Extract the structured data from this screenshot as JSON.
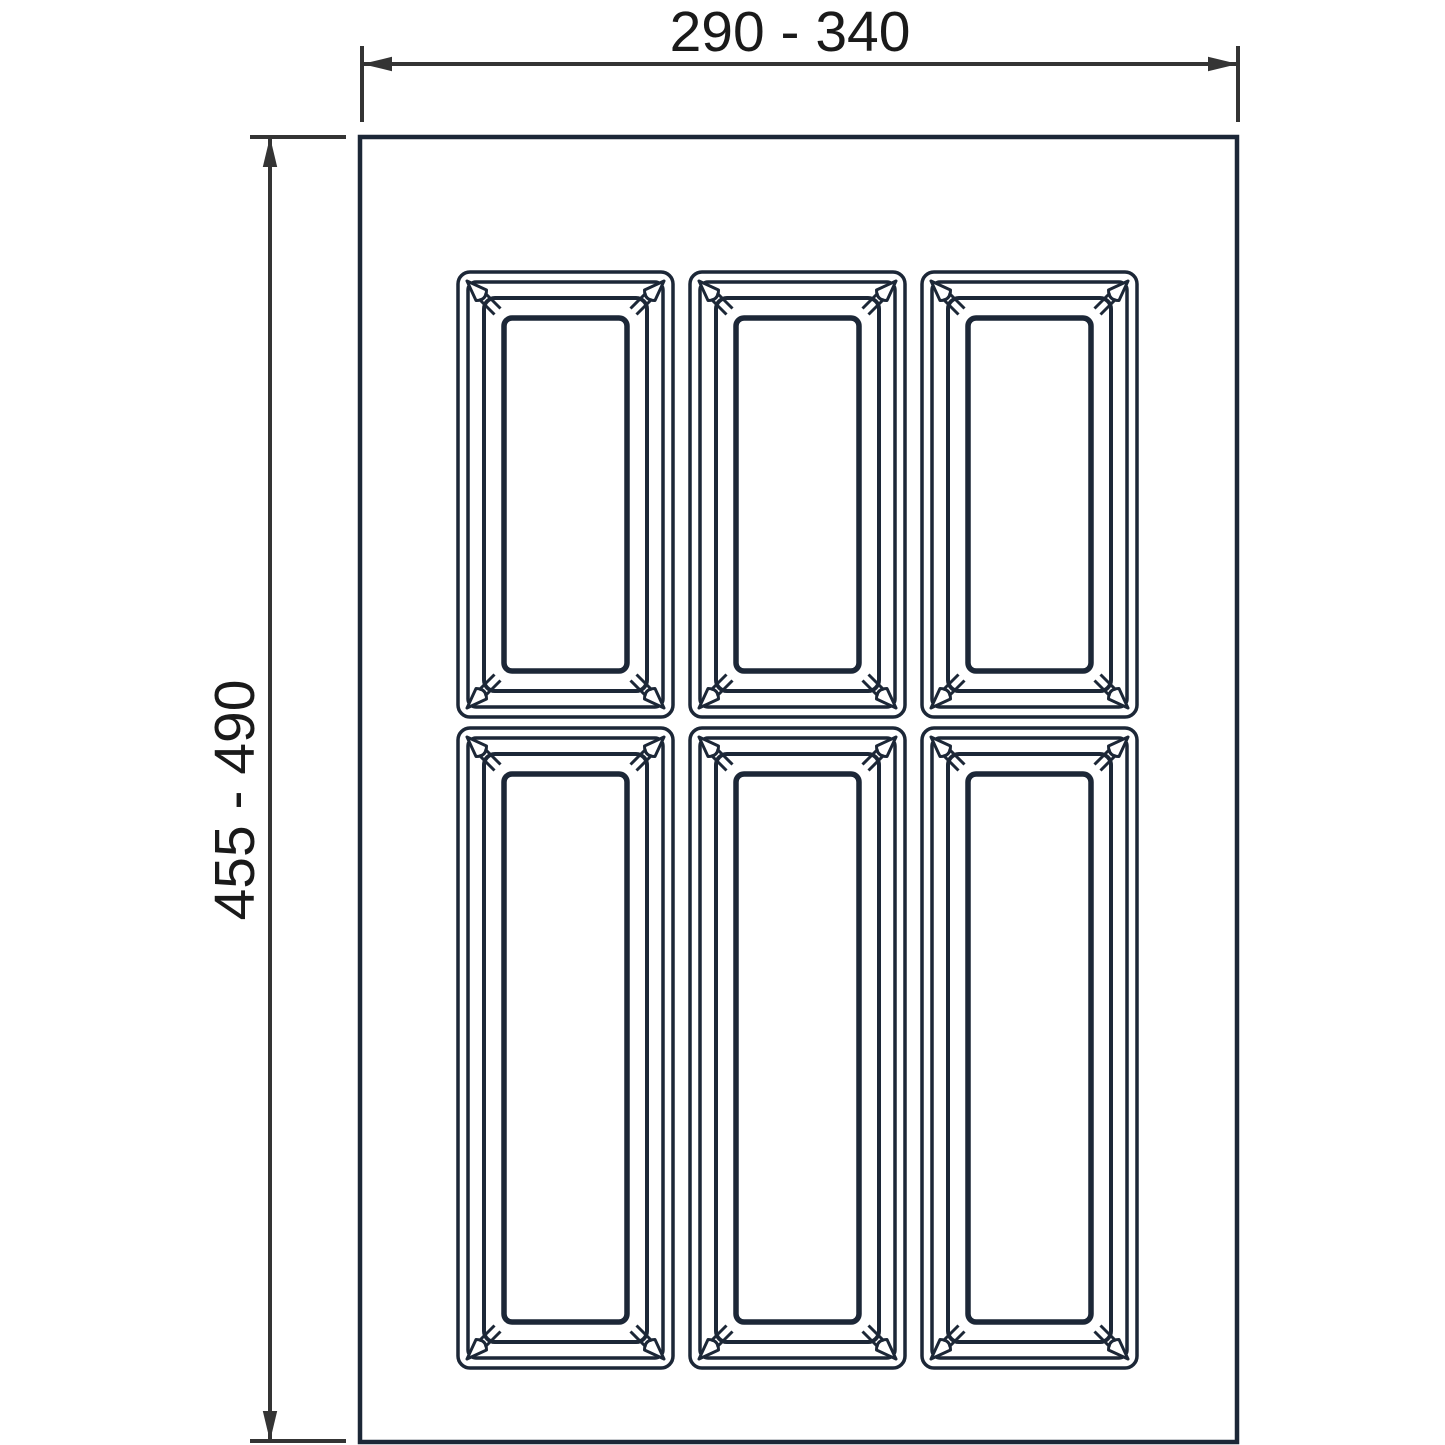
{
  "diagram": {
    "type": "technical-drawing",
    "subject": "cutlery-tray-insert-top-view",
    "width_label": "290 - 340",
    "height_label": "455 - 490",
    "colors": {
      "drawing_line": "#1c2737",
      "dimension_line": "#343434",
      "label_text": "#1a1a1a",
      "background": "#ffffff"
    },
    "tray": {
      "x": 360,
      "y": 137,
      "w": 877,
      "h": 1305
    },
    "layout": {
      "rows": 2,
      "cols": 3,
      "compartment_count": 6
    },
    "compartments": [
      {
        "x": 458,
        "y": 272,
        "w": 215,
        "h": 445
      },
      {
        "x": 690,
        "y": 272,
        "w": 215,
        "h": 445
      },
      {
        "x": 922,
        "y": 272,
        "w": 215,
        "h": 445
      },
      {
        "x": 458,
        "y": 728,
        "w": 215,
        "h": 640
      },
      {
        "x": 690,
        "y": 728,
        "w": 215,
        "h": 640
      },
      {
        "x": 922,
        "y": 728,
        "w": 215,
        "h": 640
      }
    ],
    "width_dimension": {
      "line_y": 64,
      "x1": 362,
      "x2": 1238,
      "tick_y1": 46,
      "tick_y2": 122,
      "label_x": 790,
      "label_baseline_y": 51
    },
    "height_dimension": {
      "line_x": 270,
      "y1": 137,
      "y2": 1441,
      "tick_x1": 250,
      "tick_x2": 346,
      "label_x": 254,
      "label_center_y": 800
    }
  }
}
